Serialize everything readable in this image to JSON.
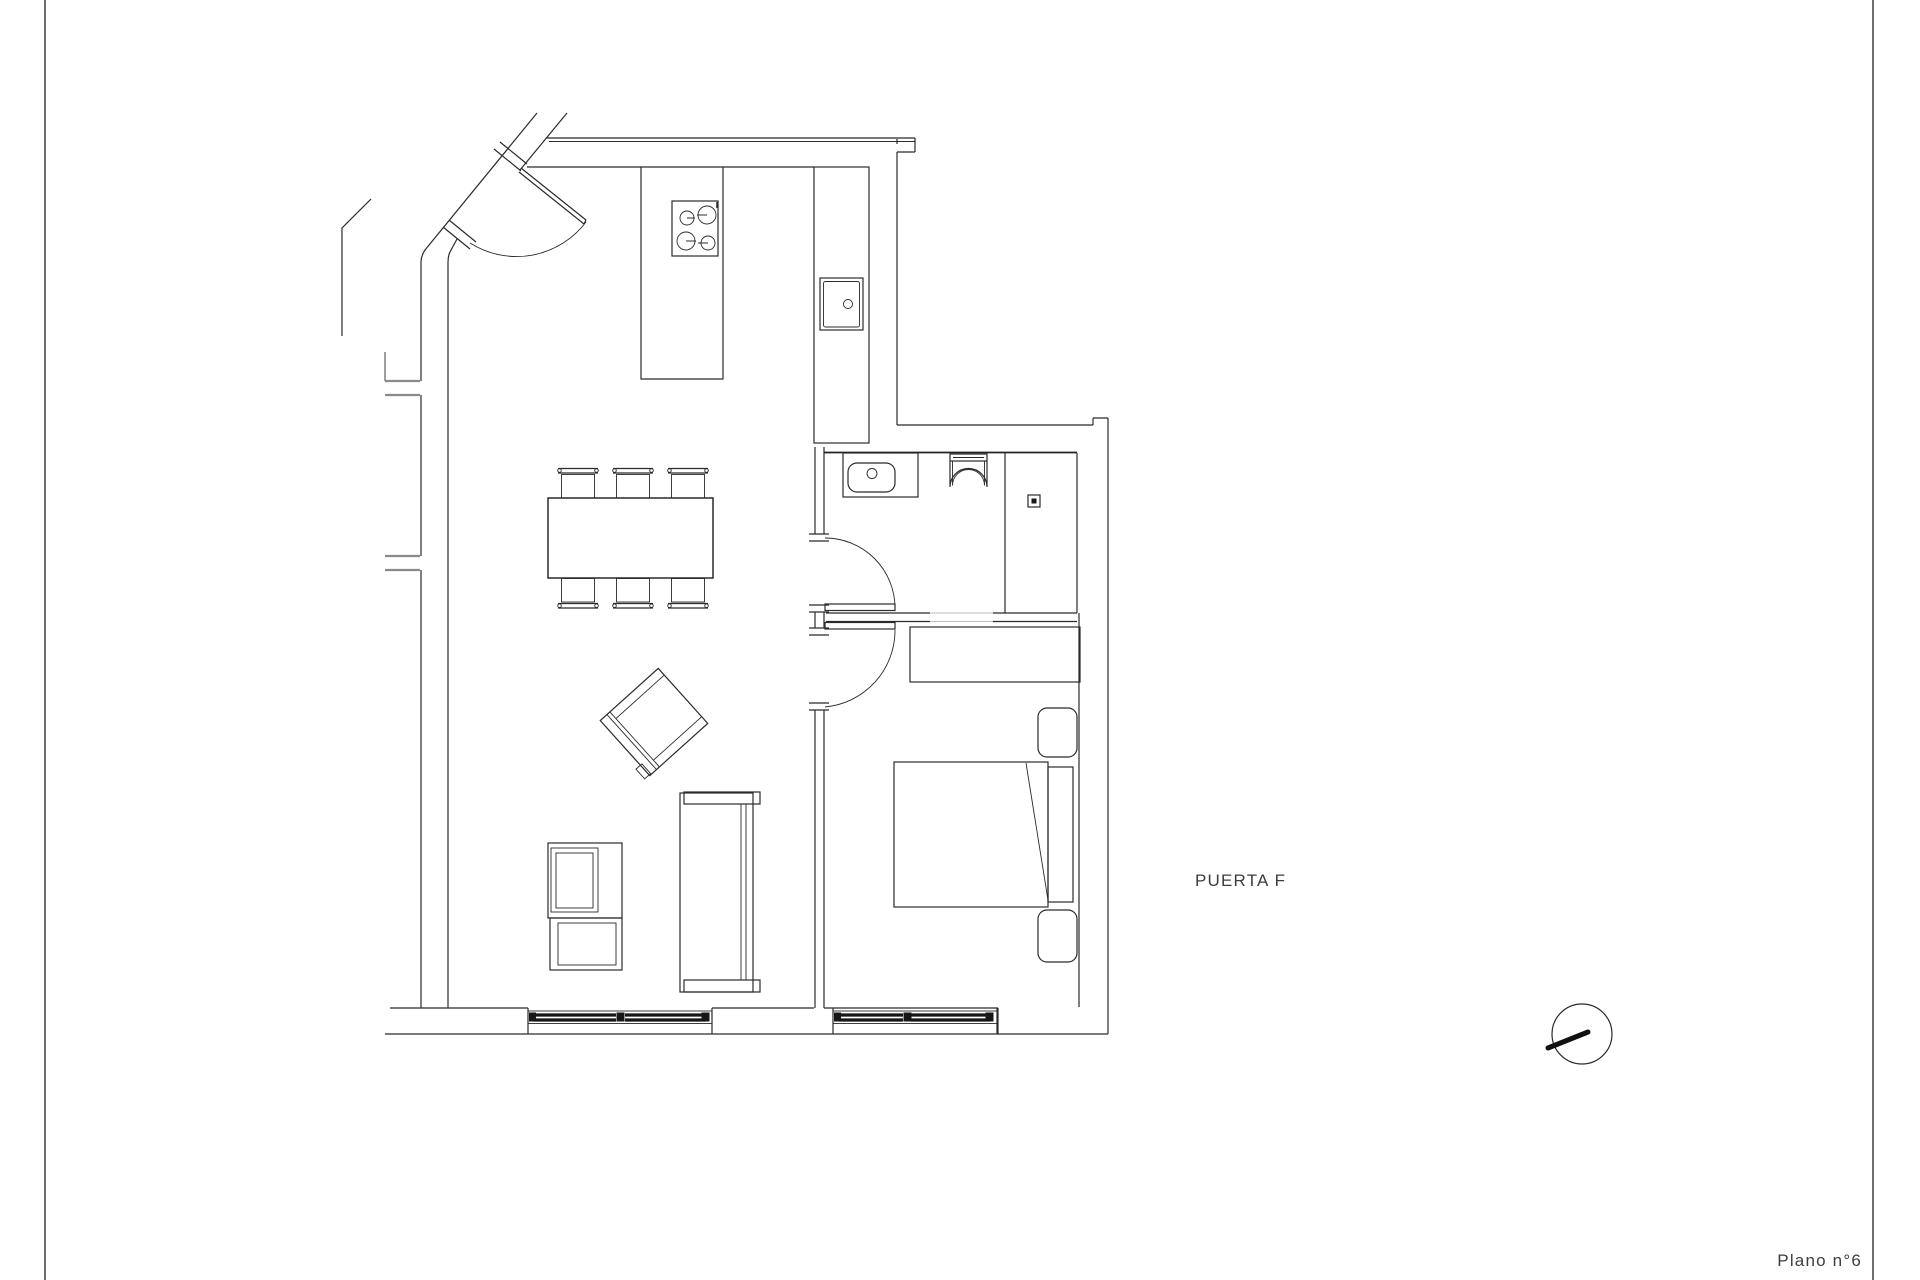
{
  "page": {
    "background": "#ffffff",
    "frame_line_color": "#4a4a4a",
    "drawing_line_color": "#2b2b2b",
    "glazing_color": "#161616",
    "text_color": "#3d3d3d"
  },
  "labels": {
    "puerta": "PUERTA F",
    "plano": "Plano n°6"
  },
  "symbols": [
    "entry-door",
    "kitchen-island",
    "stove-4-burners",
    "kitchen-sink",
    "dining-table",
    "dining-chairs-x6",
    "armchair",
    "sofa",
    "tv-unit",
    "bathroom-door",
    "bedroom-door",
    "bathroom-sink",
    "toilet",
    "shower-drain",
    "wardrobe",
    "double-bed",
    "nightstand-x2",
    "window-living",
    "window-bedroom",
    "north-compass"
  ]
}
